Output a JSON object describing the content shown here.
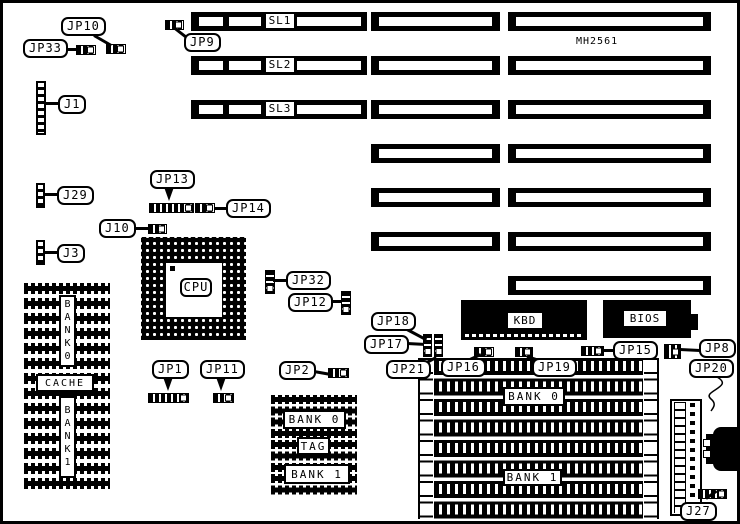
{
  "part_number": "MH2561",
  "slots": {
    "sl1": "SL1",
    "sl2": "SL2",
    "sl3": "SL3"
  },
  "chips": {
    "cpu": "CPU",
    "kbd": "KBD",
    "bios": "BIOS"
  },
  "connectors": {
    "jp10": "JP10",
    "jp33": "JP33",
    "jp9": "JP9",
    "j1": "J1",
    "j29": "J29",
    "jp13": "JP13",
    "jp14": "JP14",
    "j10": "J10",
    "j3": "J3",
    "jp32": "JP32",
    "jp12": "JP12",
    "jp1": "JP1",
    "jp11": "JP11",
    "jp2": "JP2",
    "jp18": "JP18",
    "jp17": "JP17",
    "jp21": "JP21",
    "jp16": "JP16",
    "jp19": "JP19",
    "jp15": "JP15",
    "jp8": "JP8",
    "jp20": "JP20",
    "j27": "J27"
  },
  "cache_column": {
    "bank0": "BANK0",
    "cache": "CACHE",
    "bank1": "BANK1"
  },
  "ram_block": {
    "bank0": "BANK 0",
    "tag": "TAG",
    "bank1": "BANK 1"
  },
  "simm_banks": {
    "bank0": "BANK 0",
    "bank1": "BANK 1"
  },
  "colors": {
    "ink": "#000000",
    "paper": "#ffffff"
  }
}
